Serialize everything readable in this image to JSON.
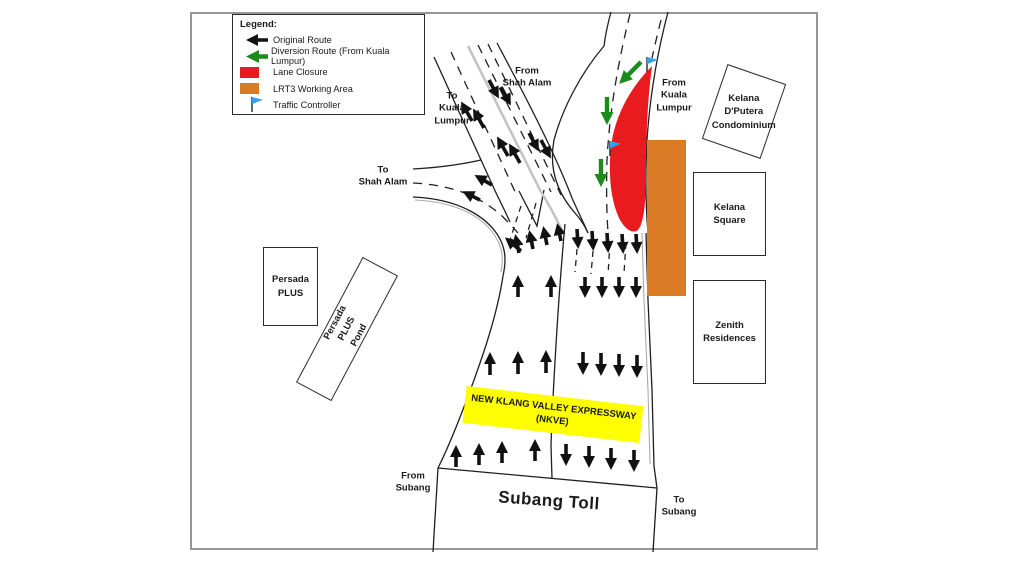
{
  "colors": {
    "lane_closure": "#EA1B1E",
    "diversion_route": "#1B8C1B",
    "lrt3_area": "#DB7B26",
    "traffic_flag": "#33A1EC",
    "highlight_yellow": "#FFFF00"
  },
  "legend": {
    "title": "Legend:",
    "items": [
      {
        "symbol": "black-arrow",
        "label": "Original Route"
      },
      {
        "symbol": "green-arrow",
        "label": "Diversion Route (From Kuala Lumpur)"
      },
      {
        "symbol": "red-swatch",
        "label": "Lane Closure"
      },
      {
        "symbol": "orange-swatch",
        "label": "LRT3 Working Area"
      },
      {
        "symbol": "blue-flag",
        "label": "Traffic Controller"
      }
    ]
  },
  "road_labels": {
    "from_shah_alam": "From\nShah Alam",
    "to_kuala_lumpur": "To\nKuala\nLumpur",
    "to_shah_alam": "To\nShah Alam",
    "from_kuala_lumpur": "From\nKuala\nLumpur",
    "from_subang": "From\nSubang",
    "to_subang": "To\nSubang",
    "subang_toll": "Subang Toll",
    "nkve": "NEW KLANG VALLEY EXPRESSWAY\n(NKVE)"
  },
  "buildings": {
    "kelana_dputera": "Kelana\nD'Putera\nCondominium",
    "kelana_square": "Kelana\nSquare",
    "zenith_residences": "Zenith\nResidences",
    "persada_plus": "Persada\nPLUS",
    "persada_plus_pond": "Persada PLUS\nPond"
  }
}
